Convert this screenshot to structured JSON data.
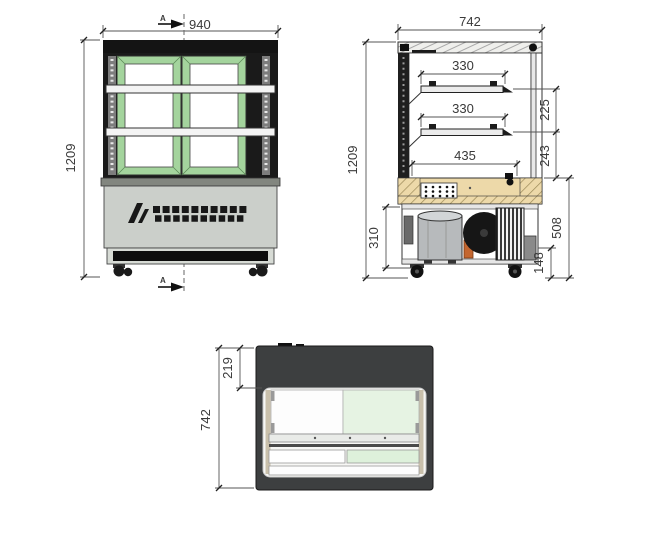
{
  "colors": {
    "door_frame_green": "#a4d49d",
    "glass_tint_green": "#e6f3e3",
    "glass_tint_green_light": "#def1db",
    "cabinet_gray": "#cbcfca",
    "deck_wood_tan": "#edd9a9",
    "top_view_body": "#3d3f40",
    "frame_black": "#141414",
    "dimension_line": "#4a4a4a"
  },
  "front_view": {
    "width_dim": "940",
    "height_dim": "1209",
    "section_marker_top": "A",
    "section_marker_bottom": "A"
  },
  "side_view": {
    "width_dim": "742",
    "height_dim": "1209",
    "shelf_depth_upper": "330",
    "shelf_depth_lower": "330",
    "base_shelf_depth": "435",
    "shelf_gap": "225",
    "shelf_to_counter": "243",
    "machine_bay_height": "310",
    "lower_section_height": "508",
    "caster_clearance": "148"
  },
  "top_view": {
    "overall_depth": "742",
    "rear_inset": "219"
  }
}
